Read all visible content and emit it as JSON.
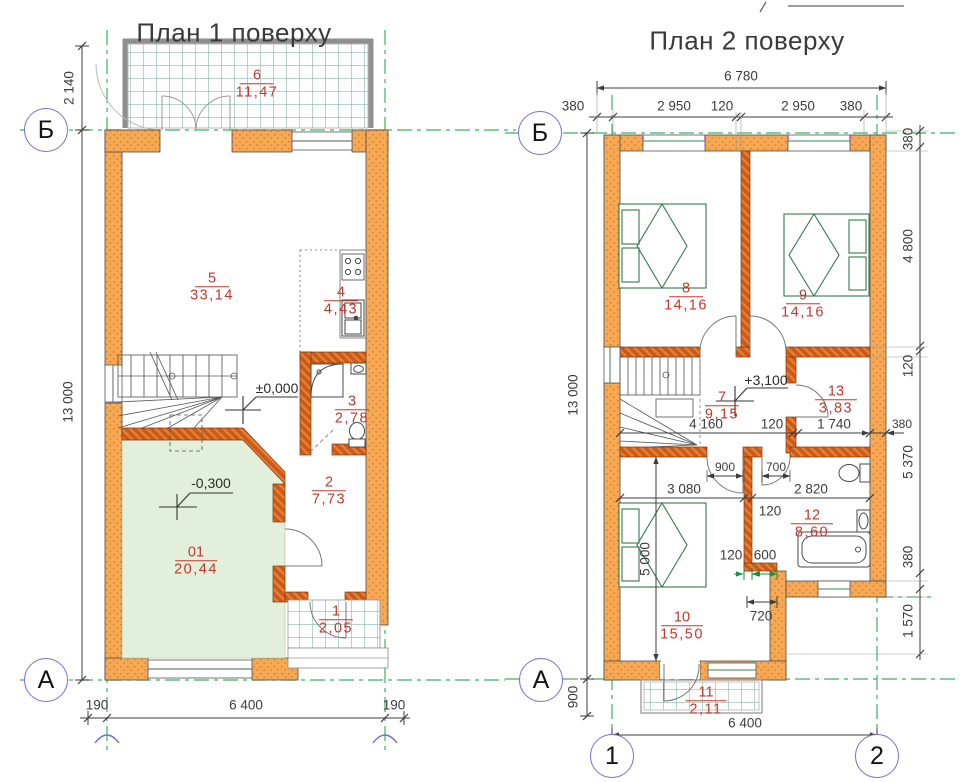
{
  "colors": {
    "wall_fill": "#F6A854",
    "wall_dot": "#D07A1D",
    "partition": "#CA5A18",
    "axis_green": "#3CB261",
    "label_red": "#C0392F",
    "room_fill": "#E2EFDA",
    "tile_line": "#6FA99A",
    "circle_blue": "#7470D0",
    "dim_text": "#3C3C3C"
  },
  "plan1": {
    "title": "План 1 поверху",
    "axis_labels": {
      "b": "Б",
      "a": "А"
    },
    "levels": {
      "zero": "±0,000",
      "minus": "-0,300"
    },
    "rooms": {
      "r6": {
        "num": "6",
        "area": "11,47"
      },
      "r5": {
        "num": "5",
        "area": "33,14"
      },
      "r4": {
        "num": "4",
        "area": "4,43"
      },
      "r3": {
        "num": "3",
        "area": "2,78"
      },
      "r2": {
        "num": "2",
        "area": "7,73"
      },
      "r01": {
        "num": "01",
        "area": "20,44"
      },
      "r1": {
        "num": "1",
        "area": "2,05"
      }
    },
    "dims": {
      "v_top": "2 140",
      "v_main": "13 000",
      "b_left": "190",
      "b_mid": "6 400",
      "b_right": "190"
    }
  },
  "plan2": {
    "title": "План 2 поверху",
    "axis_labels": {
      "b": "Б",
      "a": "А",
      "c1": "1",
      "c2": "2"
    },
    "levels": {
      "floor": "+3,100"
    },
    "rooms": {
      "r8": {
        "num": "8",
        "area": "14,16"
      },
      "r9": {
        "num": "9",
        "area": "14,16"
      },
      "r7": {
        "num": "7",
        "area": "9,15"
      },
      "r13": {
        "num": "13",
        "area": "3,83"
      },
      "r12": {
        "num": "12",
        "area": "8,60"
      },
      "r10": {
        "num": "10",
        "area": "15,50"
      },
      "r11": {
        "num": "11",
        "area": "2,11"
      }
    },
    "dims": {
      "total": "6 780",
      "top": [
        "380",
        "2 950",
        "120",
        "2 950",
        "380"
      ],
      "v_main": "13 000",
      "v_porch": "900",
      "right": [
        "380",
        "4 800",
        "120",
        "5 370",
        "380",
        "1 570"
      ],
      "wall": "380",
      "hall": [
        "4 160",
        "120",
        "1 740"
      ],
      "door_a": "900",
      "door_b": "700",
      "split": [
        "3 080",
        "2 820"
      ],
      "wall_b": "120",
      "v_room10": "5 000",
      "jog": [
        "120",
        "600"
      ],
      "jog_b": "720",
      "bottom": "6 400"
    }
  }
}
